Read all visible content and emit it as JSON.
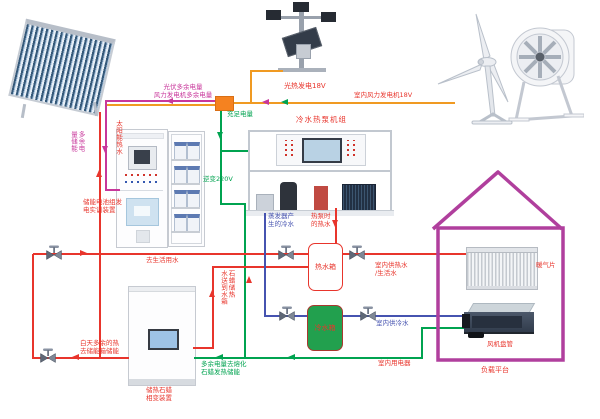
{
  "colors": {
    "mag": "#c8379b",
    "org": "#f09a22",
    "grn": "#00a350",
    "red": "#e8352c",
    "blu": "#4653b0",
    "house": "#b03f9d",
    "junction": "#f58220",
    "coldtank": "#22a04e"
  },
  "power_labels": {
    "pv_excess_line1": "光伏多余电量",
    "pv_excess_line2": "风力发电机多余电量",
    "sufficient": "充足电量",
    "storage_col1": "多余电",
    "storage_col2": "量储能",
    "inverter": "逆变220V",
    "solar_gen": "光热发电18V",
    "indoor_wind_gen": "室内风力发电机18V",
    "melt_line1": "多余电量去熔化",
    "melt_line2": "石蜡发热储能",
    "indoor_appliances": "室内用电器"
  },
  "water_labels": {
    "solar_hot": "太阳能热水",
    "to_domestic": "去生活用水",
    "daytime_line1": "白天多余的热",
    "daytime_line2": "去储能箱储能",
    "paraffin_send_col1": "石蜡储热",
    "paraffin_send_col2": "水送到水箱",
    "evap_line1": "蒸发器产",
    "evap_line2": "生的冷水",
    "hp_hot_line1": "热泵时",
    "hp_hot_line2": "的热水",
    "hot_tank": "热水箱",
    "cold_tank": "冷水箱",
    "indoor_hot_line1": "室内供热水",
    "indoor_hot_line2": "/生活水",
    "indoor_cold": "室内供冷水"
  },
  "equipment_labels": {
    "battery_line1": "储能电池组发",
    "battery_line2": "电实训装置",
    "heatpump_title": "冷水热泵机组",
    "paraffin_line1": "储热石蜡",
    "paraffin_line2": "相变装置",
    "radiator": "暖气片",
    "fan_coil": "风机盘管",
    "load_platform": "负载平台"
  }
}
